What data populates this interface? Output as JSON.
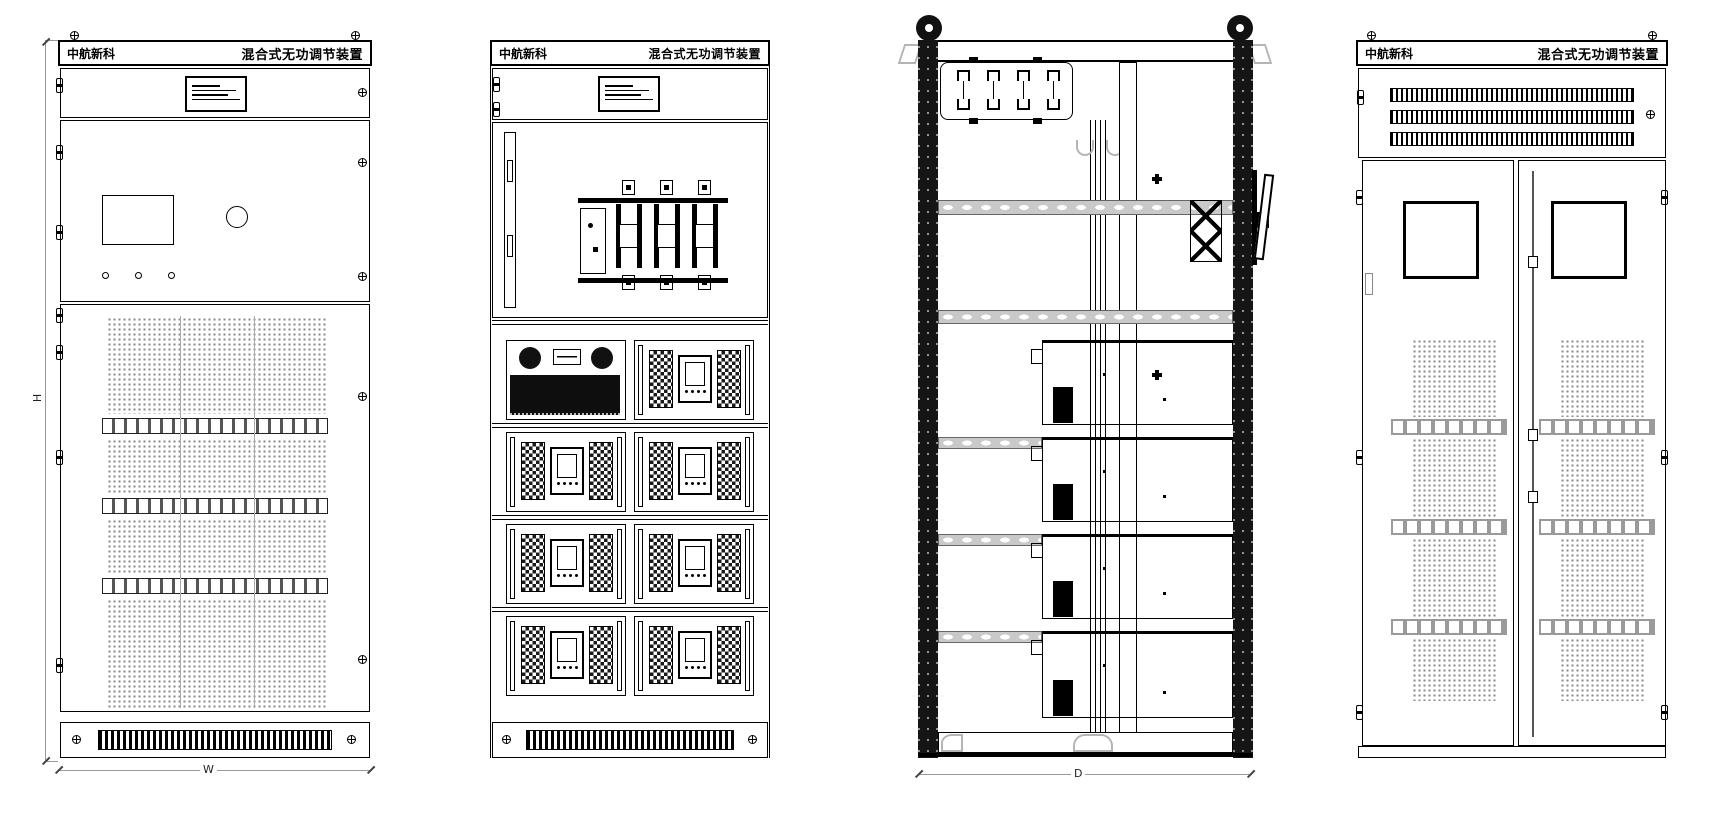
{
  "header": {
    "brand": "中航新科",
    "title": "混合式无功调节装置"
  },
  "dimensions": {
    "height_label": "H",
    "width_label": "W",
    "depth_label": "D"
  },
  "colors": {
    "ink": "#000000",
    "mesh_gray": "#8f8f8f",
    "hardware_gray": "#b5b5b5",
    "rail_gray": "#c9c9c9"
  }
}
